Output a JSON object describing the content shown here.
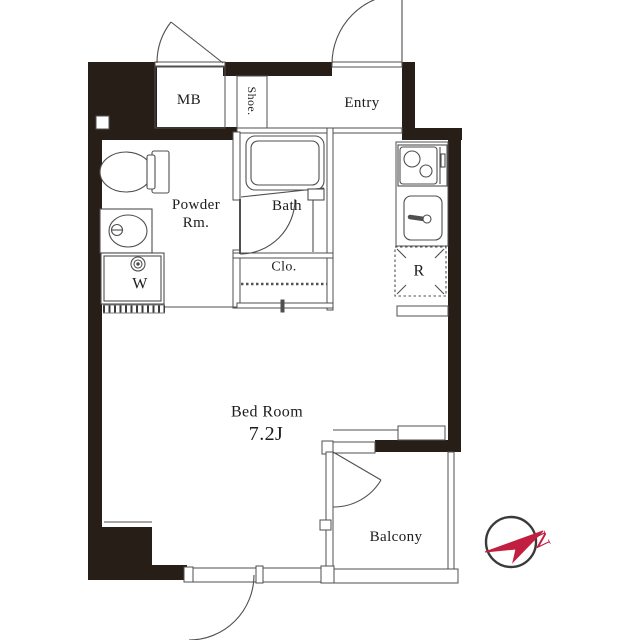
{
  "floorplan": {
    "rooms": {
      "mb": "MB",
      "shoe": "Shoe.",
      "entry": "Entry",
      "powder": "Powder Rm.",
      "bath": "Bath",
      "closet": "Clo.",
      "washer": "W",
      "refrigerator": "R",
      "bedroom_name": "Bed Room",
      "bedroom_size": "7.2J",
      "balcony": "Balcony"
    },
    "compass": {
      "letter": "N",
      "color": "#c21e3f"
    },
    "colors": {
      "wall": "#281e18",
      "line": "#4f4f4f",
      "text": "#1c1c1c",
      "background": "#ffffff"
    }
  }
}
